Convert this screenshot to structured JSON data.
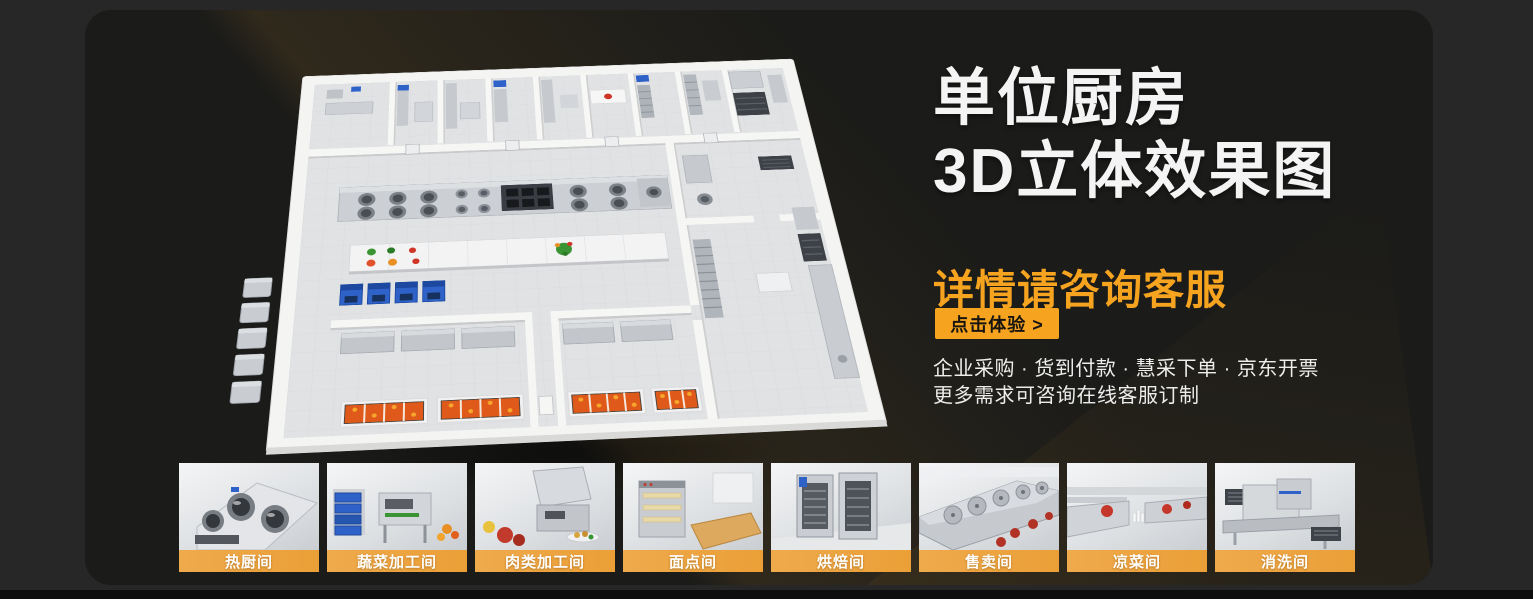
{
  "hero": {
    "title_line1": "单位厨房",
    "title_line2": "3D立体效果图",
    "subtitle": "详情请咨询客服",
    "cta_label": "点击体验 >",
    "desc_line1": "企业采购 · 货到付款 · 慧采下单 · 京东开票",
    "desc_line2": "更多需求可咨询在线客服订制"
  },
  "colors": {
    "page_bg": "#272727",
    "panel_bg": "#1b1b19",
    "accent_orange": "#f6a41f",
    "title_white": "#f4f4f4",
    "thumb_label_gradient": [
      "#efaa4c",
      "#eb9f37"
    ]
  },
  "thumbnails": [
    {
      "label": "热厨间"
    },
    {
      "label": "蔬菜加工间"
    },
    {
      "label": "肉类加工间"
    },
    {
      "label": "面点间"
    },
    {
      "label": "烘焙间"
    },
    {
      "label": "售卖间"
    },
    {
      "label": "凉菜间"
    },
    {
      "label": "消洗间"
    }
  ]
}
